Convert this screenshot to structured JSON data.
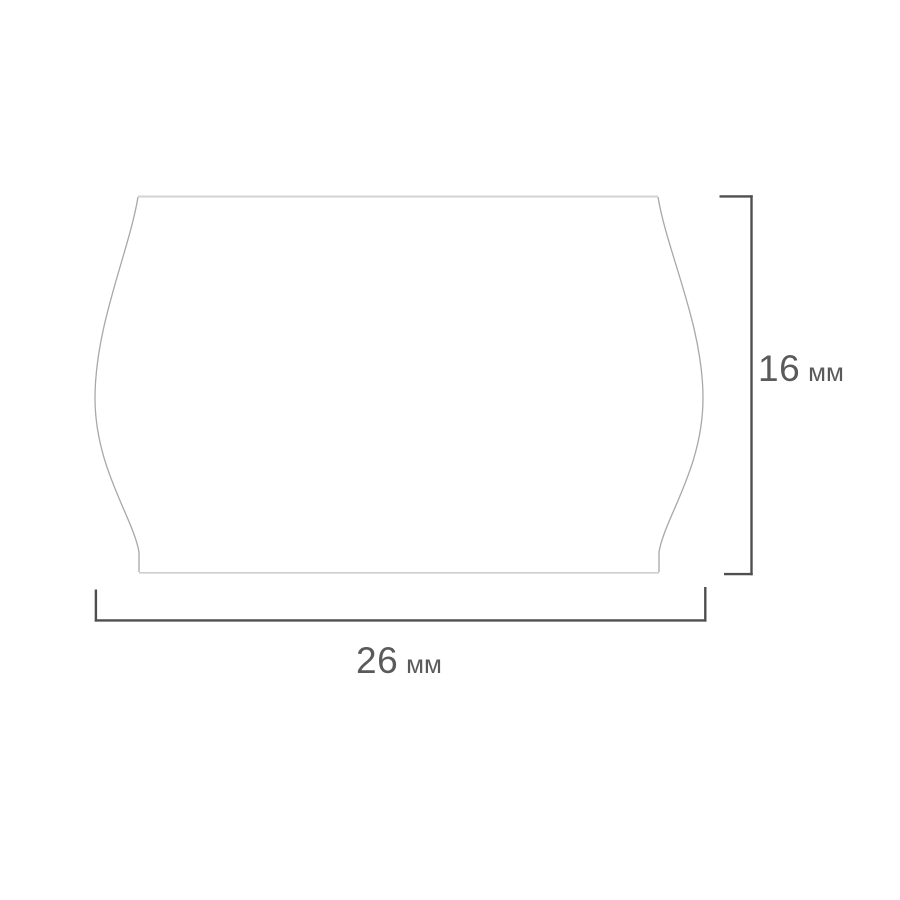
{
  "diagram": {
    "title": "price-label-dimension-drawing",
    "dimensions": {
      "height": {
        "value": "16",
        "unit": "мм"
      },
      "width": {
        "value": "26",
        "unit": "мм"
      }
    },
    "colors": {
      "background": "#ffffff",
      "label_top_edge": "#d3d3d3",
      "label_bottom_edge": "#cfcfcf",
      "label_side_edge": "#a8a8a8",
      "dimension_line": "#4f4f4f",
      "dimension_text": "#5a5a5a"
    }
  }
}
